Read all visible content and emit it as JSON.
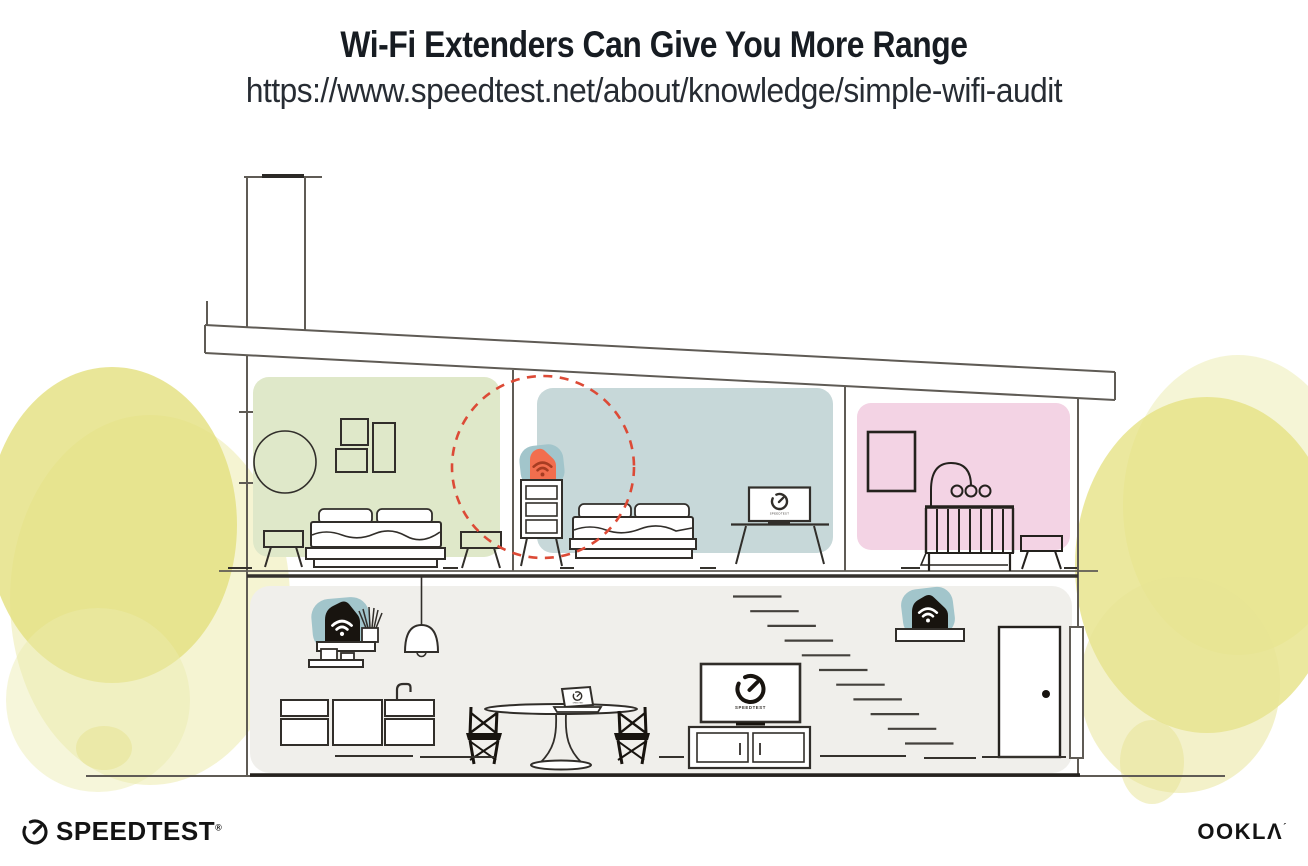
{
  "header": {
    "title": "Wi-Fi Extenders Can Give You More Range",
    "url": "https://www.speedtest.net/about/knowledge/simple-wifi-audit"
  },
  "illustration": {
    "screen_label": "SPEEDTEST"
  },
  "footer": {
    "speedtest_wordmark": "SPEEDTEST",
    "speedtest_registered_mark": "®",
    "ookla_wordmark": "OOKLΛ",
    "ookla_mark": "´"
  },
  "icons": {
    "speedtest_gauge": "speedtest-gauge-icon",
    "wifi": "wifi-icon"
  },
  "colors": {
    "room_green": "#dfe8c9",
    "room_blue": "#c7d8d9",
    "room_pink": "#f3d3e4",
    "lower_floor": "#f0efeb",
    "device_teal": "#a2c5cb",
    "extender_orange": "#f26e4e",
    "range_dash_red": "#dc4a36",
    "foliage_yellow": "#e4e07e",
    "line_gray": "#5f5b55",
    "ink": "#17191d"
  }
}
